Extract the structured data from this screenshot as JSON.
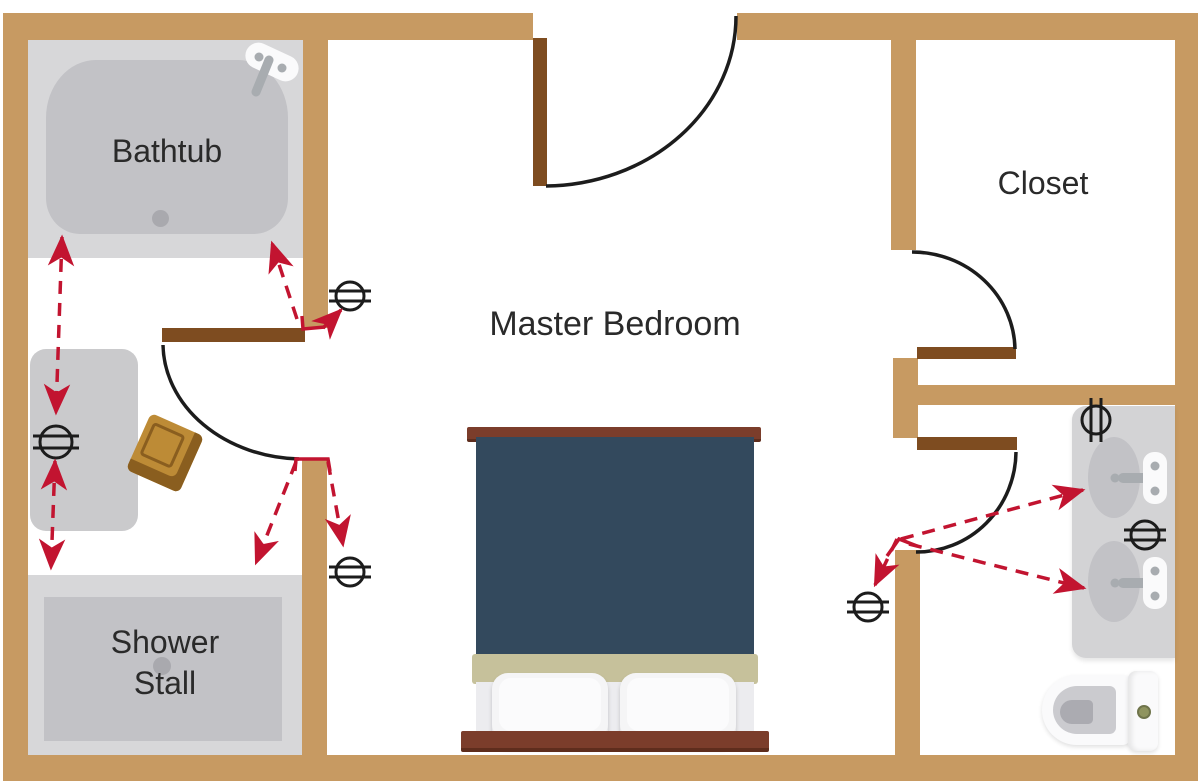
{
  "diagram": {
    "type": "floor-plan",
    "labels": {
      "bathtub": "Bathtub",
      "shower_line1": "Shower",
      "shower_line2": "Stall",
      "master_bedroom": "Master Bedroom",
      "closet": "Closet"
    },
    "colors": {
      "floor": "#FFFFFF",
      "wall": "#C79A62",
      "door_panel": "#7E4C20",
      "swing_line": "#1C1C1C",
      "arrow_red": "#C21430",
      "label_text": "#2A2A2A",
      "platform_gray": "#D7D7D9",
      "fixture_gray": "#C2C2C6",
      "detail_gray": "#A9A9AE",
      "vanity_gray": "#CACACC",
      "counter_gray": "#D3D3D5",
      "basin_gray": "#C2C2C6",
      "fixture_white": "#FAFAFB",
      "metal_gray": "#A8ACB0",
      "bed_comforter": "#33495D",
      "bed_wood": "#7B3D2B",
      "bed_wood_dark": "#5E2D1D",
      "bed_blanket": "#C6C19B",
      "bed_sheet": "#ECECEF",
      "pillow_white": "#F5F5F6",
      "basket_gold": "#BD8B36",
      "basket_dark": "#8A5E1F",
      "toilet_seat": "#CBCBCF",
      "toilet_bowl_inner": "#ABABB1",
      "flush_button": "#8F945F"
    },
    "outlet_symbols": [
      {
        "id": "outlet-bath-door-top",
        "x": 350,
        "y": 296,
        "orientation": "horizontal"
      },
      {
        "id": "outlet-vanity",
        "x": 56,
        "y": 442,
        "orientation": "horizontal"
      },
      {
        "id": "outlet-bath-door-bottom",
        "x": 350,
        "y": 572,
        "orientation": "horizontal"
      },
      {
        "id": "outlet-sink-top",
        "x": 1096,
        "y": 420,
        "orientation": "vertical"
      },
      {
        "id": "outlet-sink-middle",
        "x": 1145,
        "y": 535,
        "orientation": "horizontal"
      },
      {
        "id": "outlet-bedroom-door-right",
        "x": 868,
        "y": 607,
        "orientation": "horizontal"
      }
    ],
    "arrows": [
      {
        "from": "bathtub",
        "to": "vanity-outlet",
        "double_headed": true
      },
      {
        "from": "vanity-outlet",
        "to": "shower-stall",
        "double_headed": true
      },
      {
        "from": "bathroom-door-top",
        "to": "bathtub",
        "double_headed": false
      },
      {
        "from": "bathroom-door-top",
        "to": "door-top-outlet",
        "double_headed": false
      },
      {
        "from": "bathroom-door-bottom",
        "to": "shower-stall",
        "double_headed": false
      },
      {
        "from": "bathroom-door-bottom",
        "to": "door-bottom-outlet",
        "double_headed": false
      },
      {
        "from": "right-bathroom-door",
        "to": "sink-top",
        "double_headed": false
      },
      {
        "from": "right-bathroom-door",
        "to": "sink-bottom",
        "double_headed": false
      },
      {
        "from": "right-bathroom-door",
        "to": "bedroom-outlet",
        "double_headed": false
      }
    ]
  }
}
